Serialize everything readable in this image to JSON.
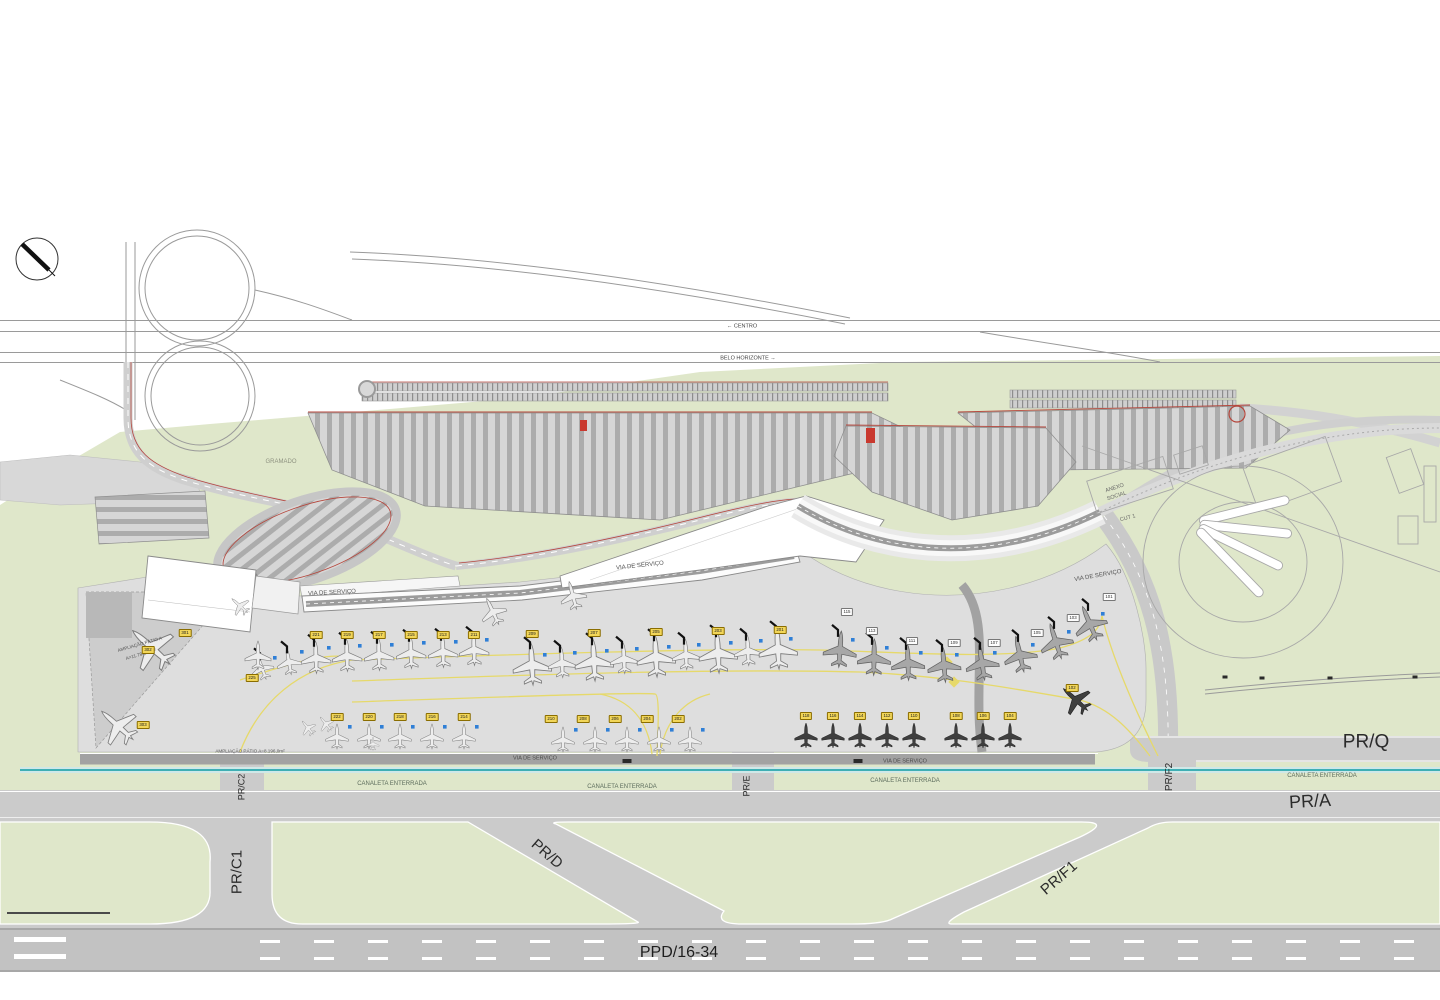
{
  "palette": {
    "green": "#dfe7ca",
    "apron": "#dedede",
    "apron_dark": "#cdcdcd",
    "taxiway": "#cbcbcb",
    "runway": "#c2c2c2",
    "road": "#cfcfcf",
    "road_dark": "#9c9c9c",
    "red_line": "#b5463c",
    "teal": "#3fafb4",
    "teal_halo": "#cfe8e8",
    "yellow_line": "#e6d96a",
    "blue_gse": "#2f7fd6",
    "building": "#ffffff",
    "outline": "#8a8a8a"
  },
  "drawing": {
    "area_labels": [
      {
        "id": "dir-centro",
        "text": "←   CENTRO",
        "x": 742,
        "y": 327,
        "size": 5.5,
        "rot": 0,
        "color": "#444"
      },
      {
        "id": "dir-belo-horizonte",
        "text": "BELO  HORIZONTE   →",
        "x": 748,
        "y": 359,
        "size": 5.5,
        "rot": 0,
        "color": "#444"
      },
      {
        "id": "gramado",
        "text": "GRAMADO",
        "x": 281,
        "y": 462,
        "size": 6,
        "rot": 0,
        "color": "#8e9280"
      },
      {
        "id": "anexo-1",
        "text": "ANEXO",
        "x": 1115,
        "y": 489,
        "size": 5.5,
        "rot": -18,
        "color": "#666"
      },
      {
        "id": "anexo-2",
        "text": "SOCIAL",
        "x": 1117,
        "y": 497,
        "size": 5.5,
        "rot": -18,
        "color": "#666"
      },
      {
        "id": "cut-1",
        "text": "CUT  1",
        "x": 1128,
        "y": 519,
        "size": 5.5,
        "rot": -15,
        "color": "#666"
      },
      {
        "id": "via-servico-pier-w",
        "text": "VIA  DE  SERVIÇO",
        "x": 332,
        "y": 593,
        "size": 6,
        "rot": -3,
        "color": "#555"
      },
      {
        "id": "via-servico-pier-c",
        "text": "VIA  DE  SERVIÇO",
        "x": 640,
        "y": 566,
        "size": 6,
        "rot": -6,
        "color": "#555"
      },
      {
        "id": "via-servico-pier-e",
        "text": "VIA  DE  SERVIÇO",
        "x": 1098,
        "y": 576,
        "size": 6,
        "rot": -10,
        "color": "#555"
      },
      {
        "id": "via-servico-s1",
        "text": "VIA  DE  SERVIÇO",
        "x": 535,
        "y": 759,
        "size": 5.5,
        "rot": 0,
        "color": "#4a4a4a"
      },
      {
        "id": "via-servico-s2",
        "text": "VIA  DE  SERVIÇO",
        "x": 905,
        "y": 762,
        "size": 5.5,
        "rot": 0,
        "color": "#4a4a4a"
      },
      {
        "id": "canaleta-1",
        "text": "CANALETA  ENTERRADA",
        "x": 392,
        "y": 784,
        "size": 6,
        "rot": 0,
        "color": "#5d6d5d"
      },
      {
        "id": "canaleta-2",
        "text": "CANALETA  ENTERRADA",
        "x": 622,
        "y": 787,
        "size": 6,
        "rot": 0,
        "color": "#5d6d5d"
      },
      {
        "id": "canaleta-3",
        "text": "CANALETA  ENTERRADA",
        "x": 905,
        "y": 781,
        "size": 6,
        "rot": 0,
        "color": "#5d6d5d"
      },
      {
        "id": "canaleta-4",
        "text": "CANALETA  ENTERRADA",
        "x": 1322,
        "y": 776,
        "size": 6,
        "rot": 0,
        "color": "#5d6d5d"
      },
      {
        "id": "ampliacao-patio-a1",
        "text": "AMPLIAÇÃO  PÁTIO  A",
        "x": 140,
        "y": 645,
        "size": 4.6,
        "rot": -16,
        "color": "#555"
      },
      {
        "id": "ampliacao-patio-a2",
        "text": "A=11.784,18m²",
        "x": 141,
        "y": 655,
        "size": 4.6,
        "rot": -16,
        "color": "#555"
      },
      {
        "id": "ampliacao-patio-strip",
        "text": "AMPLIAÇÃO  PÁTIO   A=8.196,0m²",
        "x": 250,
        "y": 752,
        "size": 4.6,
        "rot": 0,
        "color": "#555"
      },
      {
        "id": "taxiway-pr-q",
        "text": "PR/Q",
        "x": 1366,
        "y": 742,
        "size": 19,
        "rot": 0,
        "color": "#2b2b2b"
      },
      {
        "id": "taxiway-pr-a",
        "text": "PR/A",
        "x": 1310,
        "y": 801,
        "size": 18,
        "rot": -3,
        "color": "#2b2b2b"
      },
      {
        "id": "taxiway-pr-c1",
        "text": "PR/C1",
        "x": 237,
        "y": 872,
        "size": 15,
        "rot": -90,
        "color": "#2b2b2b"
      },
      {
        "id": "taxiway-pr-c2",
        "text": "PR/C2",
        "x": 242,
        "y": 787,
        "size": 9,
        "rot": -90,
        "color": "#2b2b2b"
      },
      {
        "id": "taxiway-pr-d",
        "text": "PR/D",
        "x": 547,
        "y": 854,
        "size": 15,
        "rot": 41,
        "color": "#2b2b2b"
      },
      {
        "id": "taxiway-pr-e",
        "text": "PR/E",
        "x": 747,
        "y": 786,
        "size": 9,
        "rot": -90,
        "color": "#2b2b2b"
      },
      {
        "id": "taxiway-pr-f1",
        "text": "PR/F1",
        "x": 1059,
        "y": 878,
        "size": 15,
        "rot": -41,
        "color": "#2b2b2b"
      },
      {
        "id": "taxiway-pr-f2",
        "text": "PR/F2",
        "x": 1170,
        "y": 777,
        "size": 10,
        "rot": -90,
        "color": "#2b2b2b"
      },
      {
        "id": "runway-ppd-16-34",
        "text": "PPD/16-34",
        "x": 679,
        "y": 953,
        "size": 16,
        "rot": 0,
        "color": "#1e1e1e"
      }
    ],
    "stand_tags": [
      {
        "num": "301",
        "x": 185,
        "y": 633,
        "style": "yellow"
      },
      {
        "num": "302",
        "x": 148,
        "y": 650,
        "style": "yellow"
      },
      {
        "num": "303",
        "x": 143,
        "y": 725,
        "style": "yellow"
      },
      {
        "num": "225",
        "x": 252,
        "y": 678,
        "style": "yellow"
      },
      {
        "num": "221",
        "x": 316,
        "y": 635,
        "style": "yellow"
      },
      {
        "num": "219",
        "x": 347,
        "y": 635,
        "style": "yellow"
      },
      {
        "num": "217",
        "x": 379,
        "y": 635,
        "style": "yellow"
      },
      {
        "num": "215",
        "x": 411,
        "y": 635,
        "style": "yellow"
      },
      {
        "num": "213",
        "x": 443,
        "y": 635,
        "style": "yellow"
      },
      {
        "num": "211",
        "x": 474,
        "y": 635,
        "style": "yellow"
      },
      {
        "num": "209",
        "x": 532,
        "y": 634,
        "style": "yellow"
      },
      {
        "num": "207",
        "x": 594,
        "y": 633,
        "style": "yellow"
      },
      {
        "num": "205",
        "x": 656,
        "y": 632,
        "style": "yellow"
      },
      {
        "num": "203",
        "x": 718,
        "y": 631,
        "style": "yellow"
      },
      {
        "num": "201",
        "x": 780,
        "y": 630,
        "style": "yellow"
      },
      {
        "num": "222",
        "x": 337,
        "y": 717,
        "style": "yellow"
      },
      {
        "num": "220",
        "x": 369,
        "y": 717,
        "style": "yellow"
      },
      {
        "num": "218",
        "x": 400,
        "y": 717,
        "style": "yellow"
      },
      {
        "num": "216",
        "x": 432,
        "y": 717,
        "style": "yellow"
      },
      {
        "num": "214",
        "x": 464,
        "y": 717,
        "style": "yellow"
      },
      {
        "num": "210",
        "x": 551,
        "y": 719,
        "style": "yellow"
      },
      {
        "num": "208",
        "x": 583,
        "y": 719,
        "style": "yellow"
      },
      {
        "num": "206",
        "x": 615,
        "y": 719,
        "style": "yellow"
      },
      {
        "num": "204",
        "x": 647,
        "y": 719,
        "style": "yellow"
      },
      {
        "num": "202",
        "x": 678,
        "y": 719,
        "style": "yellow"
      },
      {
        "num": "118",
        "x": 806,
        "y": 716,
        "style": "yellow"
      },
      {
        "num": "116",
        "x": 833,
        "y": 716,
        "style": "yellow"
      },
      {
        "num": "114",
        "x": 860,
        "y": 716,
        "style": "yellow"
      },
      {
        "num": "112",
        "x": 887,
        "y": 716,
        "style": "yellow"
      },
      {
        "num": "110",
        "x": 914,
        "y": 716,
        "style": "yellow"
      },
      {
        "num": "108",
        "x": 956,
        "y": 716,
        "style": "yellow"
      },
      {
        "num": "106",
        "x": 983,
        "y": 716,
        "style": "yellow"
      },
      {
        "num": "104",
        "x": 1010,
        "y": 716,
        "style": "yellow"
      },
      {
        "num": "102",
        "x": 1072,
        "y": 688,
        "style": "yellow"
      },
      {
        "num": "115",
        "x": 847,
        "y": 612,
        "style": "white"
      },
      {
        "num": "113",
        "x": 872,
        "y": 631,
        "style": "white"
      },
      {
        "num": "111",
        "x": 912,
        "y": 641,
        "style": "white"
      },
      {
        "num": "109",
        "x": 954,
        "y": 643,
        "style": "white"
      },
      {
        "num": "107",
        "x": 994,
        "y": 643,
        "style": "white"
      },
      {
        "num": "105",
        "x": 1037,
        "y": 633,
        "style": "white"
      },
      {
        "num": "103",
        "x": 1073,
        "y": 618,
        "style": "white"
      },
      {
        "num": "101",
        "x": 1109,
        "y": 597,
        "style": "white"
      }
    ],
    "planes": {
      "contact_west": {
        "tone": "light",
        "gse": true,
        "bridge": true,
        "pts": [
          [
            316,
            658,
            -2,
            34
          ],
          [
            347,
            656,
            -2,
            34
          ],
          [
            379,
            655,
            -2,
            34
          ],
          [
            411,
            653,
            -2,
            34
          ],
          [
            443,
            652,
            -2,
            34
          ],
          [
            474,
            650,
            -2,
            34
          ],
          [
            262,
            668,
            -20,
            26
          ],
          [
            289,
            662,
            -10,
            28
          ]
        ]
      },
      "contact_center": {
        "tone": "light",
        "gse": true,
        "bridge": true,
        "pts": [
          [
            532,
            665,
            -3,
            44
          ],
          [
            562,
            663,
            -3,
            32
          ],
          [
            594,
            661,
            -3,
            44
          ],
          [
            624,
            659,
            -3,
            32
          ],
          [
            656,
            657,
            -3,
            44
          ],
          [
            686,
            655,
            -3,
            32
          ],
          [
            718,
            653,
            -3,
            44
          ],
          [
            748,
            651,
            -3,
            32
          ],
          [
            778,
            649,
            -3,
            44
          ]
        ]
      },
      "contact_east": {
        "tone": "mid",
        "gse": true,
        "bridge": true,
        "pts": [
          [
            840,
            650,
            4,
            38
          ],
          [
            874,
            658,
            1,
            38
          ],
          [
            908,
            663,
            -2,
            38
          ],
          [
            944,
            665,
            -5,
            38
          ],
          [
            982,
            663,
            -9,
            38
          ],
          [
            1020,
            655,
            -13,
            38
          ],
          [
            1056,
            642,
            -18,
            38
          ],
          [
            1090,
            624,
            -23,
            38
          ]
        ]
      },
      "west_pair": {
        "tone": "light",
        "gse": false,
        "bridge": false,
        "pts": [
          [
            493,
            612,
            -25,
            30
          ],
          [
            573,
            596,
            -15,
            30
          ]
        ]
      },
      "remote_left": {
        "tone": "light",
        "gse": true,
        "bridge": false,
        "pts": [
          [
            337,
            737,
            0,
            26
          ],
          [
            369,
            737,
            0,
            26
          ],
          [
            400,
            737,
            0,
            26
          ],
          [
            432,
            737,
            0,
            26
          ],
          [
            464,
            737,
            0,
            26
          ]
        ]
      },
      "remote_center": {
        "tone": "light",
        "gse": true,
        "bridge": false,
        "pts": [
          [
            563,
            740,
            0,
            26
          ],
          [
            595,
            740,
            0,
            26
          ],
          [
            627,
            740,
            0,
            26
          ],
          [
            659,
            740,
            0,
            26
          ],
          [
            690,
            740,
            0,
            26
          ]
        ]
      },
      "remote_dark": {
        "tone": "dark",
        "gse": false,
        "bridge": false,
        "pts": [
          [
            806,
            736,
            0,
            26
          ],
          [
            833,
            736,
            0,
            26
          ],
          [
            860,
            736,
            0,
            26
          ],
          [
            887,
            736,
            0,
            26
          ],
          [
            914,
            736,
            0,
            26
          ],
          [
            956,
            736,
            0,
            26
          ],
          [
            983,
            736,
            0,
            26
          ],
          [
            1010,
            736,
            0,
            26
          ],
          [
            1076,
            700,
            -48,
            34
          ]
        ]
      },
      "patio_a": {
        "tone": "light",
        "gse": false,
        "bridge": false,
        "pts": [
          [
            152,
            648,
            -48,
            52
          ],
          [
            118,
            726,
            -48,
            44
          ],
          [
            258,
            656,
            0,
            30
          ],
          [
            240,
            606,
            -48,
            22
          ],
          [
            308,
            728,
            -40,
            18
          ],
          [
            326,
            724,
            -40,
            18
          ],
          [
            373,
            744,
            0,
            14
          ]
        ]
      }
    },
    "vehicles": [
      [
        627,
        761,
        9,
        4
      ],
      [
        858,
        761,
        9,
        4
      ],
      [
        1225,
        677,
        5,
        3
      ],
      [
        1262,
        678,
        5,
        3
      ],
      [
        1330,
        678,
        5,
        3
      ],
      [
        1415,
        677,
        5,
        3
      ]
    ]
  }
}
